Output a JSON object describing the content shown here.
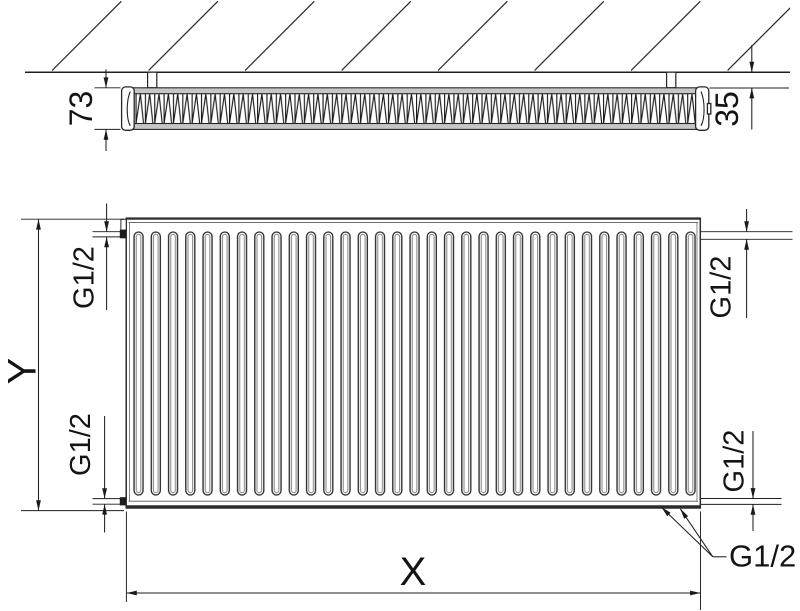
{
  "top_view": {
    "dimensions": {
      "depth": "73",
      "wall_clearance": "35"
    },
    "wall_brackets": 2
  },
  "front_view": {
    "dimensions": {
      "height": "Y",
      "width": "X",
      "thread_top_left": "G1/2",
      "thread_bottom_left": "G1/2",
      "thread_top_right": "G1/2",
      "thread_bottom_right_side": "G1/2",
      "thread_bottom": "G1/2"
    },
    "panel_grooves": 33,
    "connections": 6
  },
  "colors": {
    "line": "#1f1f1f",
    "plate_fill": "#c6c6c6",
    "groove_inner": "#8e8e8e",
    "background": "#ffffff"
  }
}
